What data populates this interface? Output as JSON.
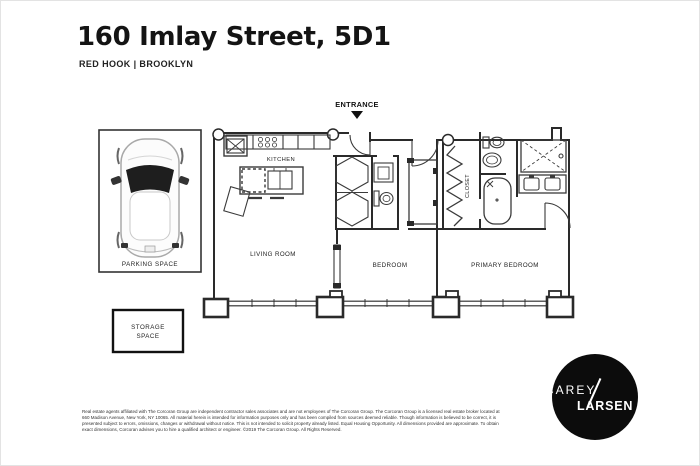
{
  "header": {
    "title": "160 Imlay Street, 5D1",
    "subtitle": "RED HOOK | BROOKLYN"
  },
  "floorplan": {
    "entrance_label": "ENTRANCE",
    "rooms": {
      "kitchen": "KITCHEN",
      "living_room": "LIVING ROOM",
      "bedroom": "BEDROOM",
      "primary_bedroom": "PRIMARY BEDROOM",
      "closet": "CLOSET"
    },
    "fixtures": [
      "range-burners",
      "kitchen-sink",
      "island-double-sink",
      "dishwasher",
      "bifold-closets",
      "toilet",
      "pedestal-sink",
      "bathtub",
      "shower",
      "double-vanity",
      "hanging-closet-rod",
      "entrance-door",
      "bedroom-door",
      "bathroom-door",
      "pocket-door",
      "window-wall-columns"
    ],
    "parking": {
      "label": "PARKING SPACE",
      "illustration": "car-top-view"
    },
    "storage": {
      "label_line1": "STORAGE",
      "label_line2": "SPACE"
    }
  },
  "logo": {
    "line1": "CAREY",
    "line2": "LARSEN"
  },
  "disclaimer": {
    "lines": [
      "Real estate agents affiliated with The Corcoran Group are independent contractor sales associates and are not employees of The Corcoran Group. The Corcoran Group is a licensed real estate broker located at",
      "660 Madison Avenue, New York, NY 10065. All material herein is intended for information purposes only and has been compiled from sources deemed reliable. Though information is believed to be correct, it is",
      "presented subject to errors, omissions, changes or withdrawal without notice. This is not intended to solicit property already listed. Equal Housing Opportunity. All dimensions provided are approximate. To obtain",
      "exact dimensions, Corcoran advises you to hire a qualified architect or engineer. ©2019 The Corcoran Group. All Rights Reserved."
    ]
  },
  "colors": {
    "ink": "#141414",
    "wall": "#2a2a2a",
    "fixture": "#3a3a3a",
    "logo_bg": "#0c0c0c"
  }
}
